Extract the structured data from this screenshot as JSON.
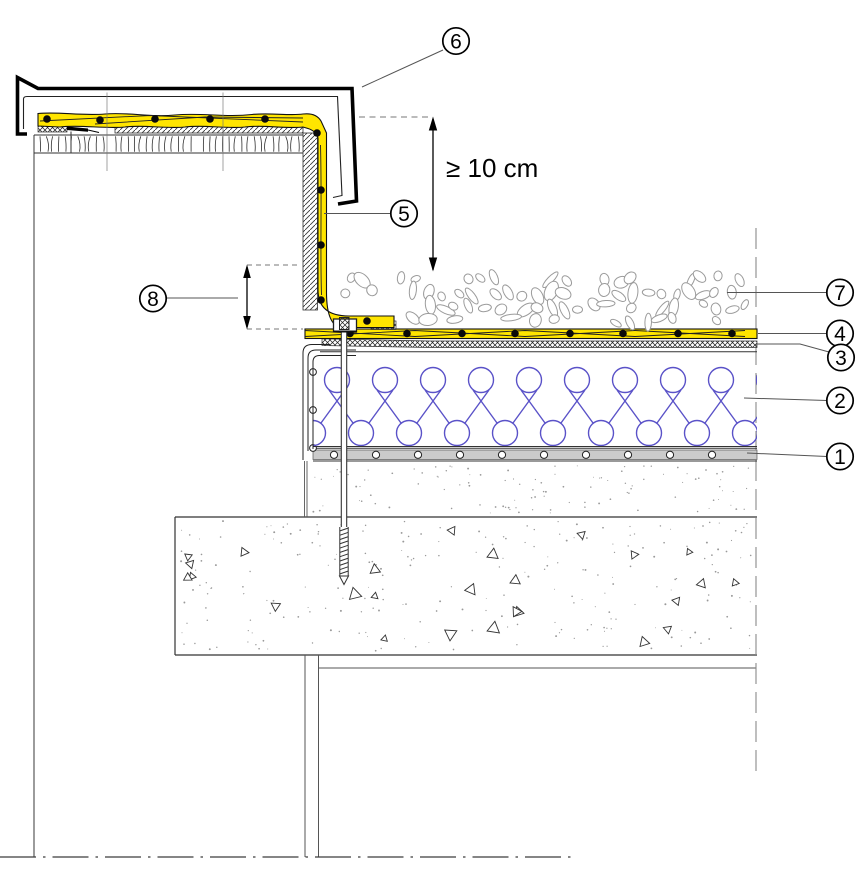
{
  "drawing": {
    "dimension_label": "≥ 10 cm",
    "callouts": [
      {
        "label": "1"
      },
      {
        "label": "2"
      },
      {
        "label": "3"
      },
      {
        "label": "4"
      },
      {
        "label": "5"
      },
      {
        "label": "6"
      },
      {
        "label": "7"
      },
      {
        "label": "8"
      }
    ],
    "colors": {
      "membrane_yellow": "#FFE500",
      "insulation_blue": "#5A52C8",
      "substrate_gray": "#CBCBCB",
      "line_black": "#000000"
    }
  }
}
